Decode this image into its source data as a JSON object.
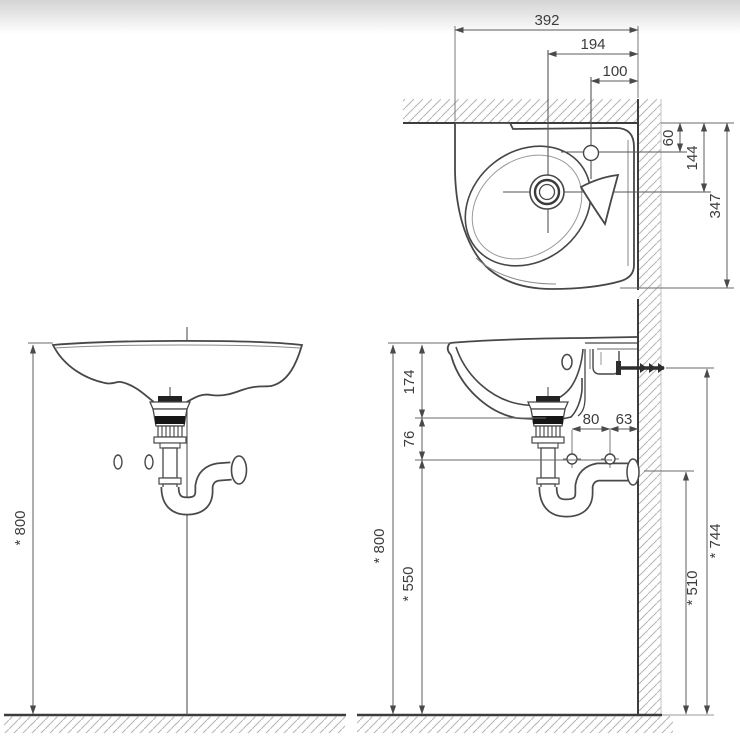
{
  "drawing_title": "corner-washbasin-technical-drawing",
  "colors": {
    "line": "#474747",
    "dimension_line": "#5c5c5c",
    "text": "#3c3c3c",
    "hatch": "#b5b5b5",
    "wall": "#3d3d3d",
    "top_gradient": "#d6d6d6"
  },
  "plan_view": {
    "dim_width": "392",
    "dim_drain_center_to_wall": "194",
    "dim_tap_hole_to_wall": "100",
    "dim_wall_to_tap_hole": "60",
    "dim_wall_to_drain_center": "144",
    "dim_depth": "347"
  },
  "front_view": {
    "dim_rim_height": "* 800"
  },
  "side_view": {
    "dim_rim_to_drain": "174",
    "dim_drain_to_fixing_holes": "76",
    "dim_fixing_hole_spacing": "80",
    "dim_fixing_hole_to_wall": "63",
    "dim_rim_height": "* 800",
    "dim_fixing_height": "* 550",
    "dim_outlet_height": "* 510",
    "dim_bracket_height": "* 744"
  }
}
